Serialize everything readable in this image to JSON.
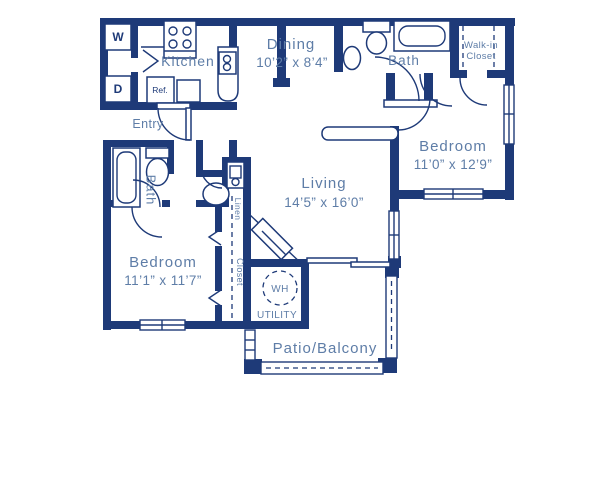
{
  "colors": {
    "wall": "#1e3a78",
    "label": "#5e7da7",
    "background": "#ffffff"
  },
  "rooms": {
    "kitchen": {
      "label": "Kitchen"
    },
    "entry": {
      "label": "Entry"
    },
    "dining": {
      "label": "Dining",
      "dims": "10’2” x 8’4”"
    },
    "bath_top": {
      "label": "Bath"
    },
    "walk_in_closet": {
      "line1": "Walk-in",
      "line2": "Closet"
    },
    "bedroom_right": {
      "label": "Bedroom",
      "dims": "11’0” x 12’9”"
    },
    "bath_left": {
      "label": "Bath"
    },
    "bedroom_left": {
      "label": "Bedroom",
      "dims": "11’1” x 11’7”"
    },
    "living": {
      "label": "Living",
      "dims": "14’5” x 16’0”"
    },
    "utility": {
      "label": "UTILITY"
    },
    "patio": {
      "label": "Patio/Balcony"
    },
    "linen": {
      "label": "Linen"
    },
    "bedroom_closet": {
      "label": "Closet"
    }
  },
  "appliances": {
    "washer": "W",
    "dryer": "D",
    "refrigerator": "Ref.",
    "water_heater": "WH"
  }
}
